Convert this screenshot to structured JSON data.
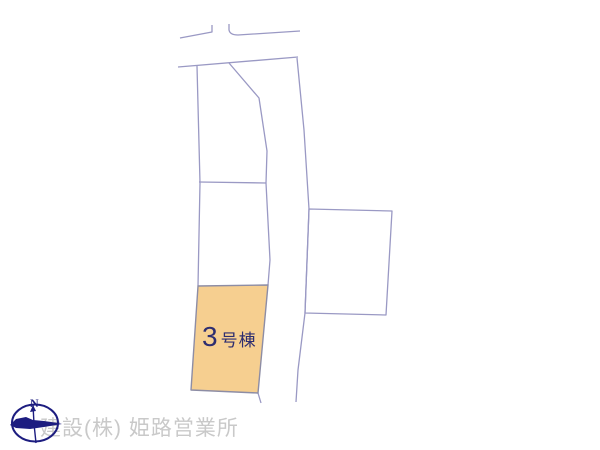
{
  "page": {
    "background": "#ffffff"
  },
  "map": {
    "parcel_label": {
      "number": "3",
      "suffix": "号棟"
    },
    "colors": {
      "boundary_line": "#9a99c4",
      "highlight_fill": "#f6cf90",
      "highlight_stroke": "#8d8da5",
      "label_text": "#2e2e70"
    }
  },
  "compass": {
    "north_label": "N",
    "color": "#1d1d80"
  },
  "watermark": {
    "text": "建設(株) 姫路営業所",
    "color": "#c9c9c9"
  }
}
